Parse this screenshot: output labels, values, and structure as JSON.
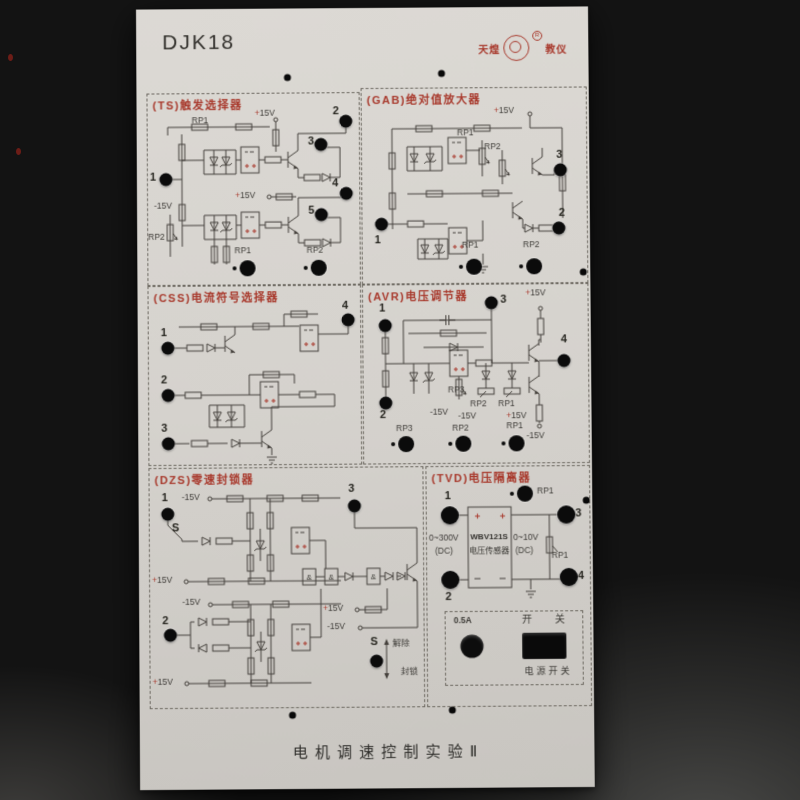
{
  "panel": {
    "model": "DJK18",
    "logo": {
      "left": "天煌",
      "right": "教仪",
      "reg": "R"
    },
    "footer_title": "电机调速控制实验Ⅱ"
  },
  "sections": {
    "ts": {
      "title": "(TS)触发选择器",
      "terminals": {
        "t1": "1",
        "t2": "2",
        "t3": "3",
        "t4": "4",
        "t5": "5"
      },
      "labels": {
        "rp1_top": "RP1",
        "p15a": "+15V",
        "p15b": "+15V",
        "n15": "-15V",
        "rp2_left": "RP2",
        "pot_rp1": "RP1",
        "pot_rp2": "RP2"
      }
    },
    "gab": {
      "title": "(GAB)绝对值放大器",
      "terminals": {
        "t1": "1",
        "t2": "2",
        "t3": "3"
      },
      "labels": {
        "p15": "+15V",
        "rp1": "RP1",
        "rp2": "RP2",
        "pot_rp1": "RP1",
        "pot_rp2": "RP2"
      }
    },
    "css": {
      "title": "(CSS)电流符号选择器",
      "terminals": {
        "t1": "1",
        "t2": "2",
        "t3": "3",
        "t4": "4"
      }
    },
    "avr": {
      "title": "(AVR)电压调节器",
      "terminals": {
        "t1": "1",
        "t2": "2",
        "t3": "3",
        "t4": "4"
      },
      "labels": {
        "p15_top": "+15V",
        "rp3": "RP3",
        "rp2": "RP2",
        "rp1": "RP1",
        "n15_rp3": "-15V",
        "n15_rp2": "-15V",
        "p15_rp1": "+15V",
        "n15_out": "-15V",
        "pot_rp3": "RP3",
        "pot_rp2": "RP2",
        "pot_rp1": "RP1"
      }
    },
    "dzs": {
      "title": "(DZS)零速封锁器",
      "terminals": {
        "t1": "1",
        "t2": "2",
        "t3": "3"
      },
      "labels": {
        "n15_a": "-15V",
        "s_top": "S",
        "p15_a": "+15V",
        "n15_b": "-15V",
        "p15_b": "+15V",
        "p15_c": "+15V",
        "n15_c": "-15V",
        "s_toggle": "S",
        "release": "解除",
        "block": "封锁",
        "gate": "&"
      }
    },
    "tvd": {
      "title": "(TVD)电压隔离器",
      "terminals": {
        "t1": "1",
        "t2": "2",
        "t3": "3",
        "t4": "4"
      },
      "labels": {
        "rp1_top": "RP1",
        "in_range": "0~300V",
        "in_unit": "(DC)",
        "sensor_model": "WBV121S",
        "sensor_name": "电压传感器",
        "out_range": "0~10V",
        "out_unit": "(DC)",
        "rp1_small": "RP1",
        "fuse": "0.5A",
        "switch": "开 关",
        "power_switch": "电源开关"
      }
    }
  }
}
